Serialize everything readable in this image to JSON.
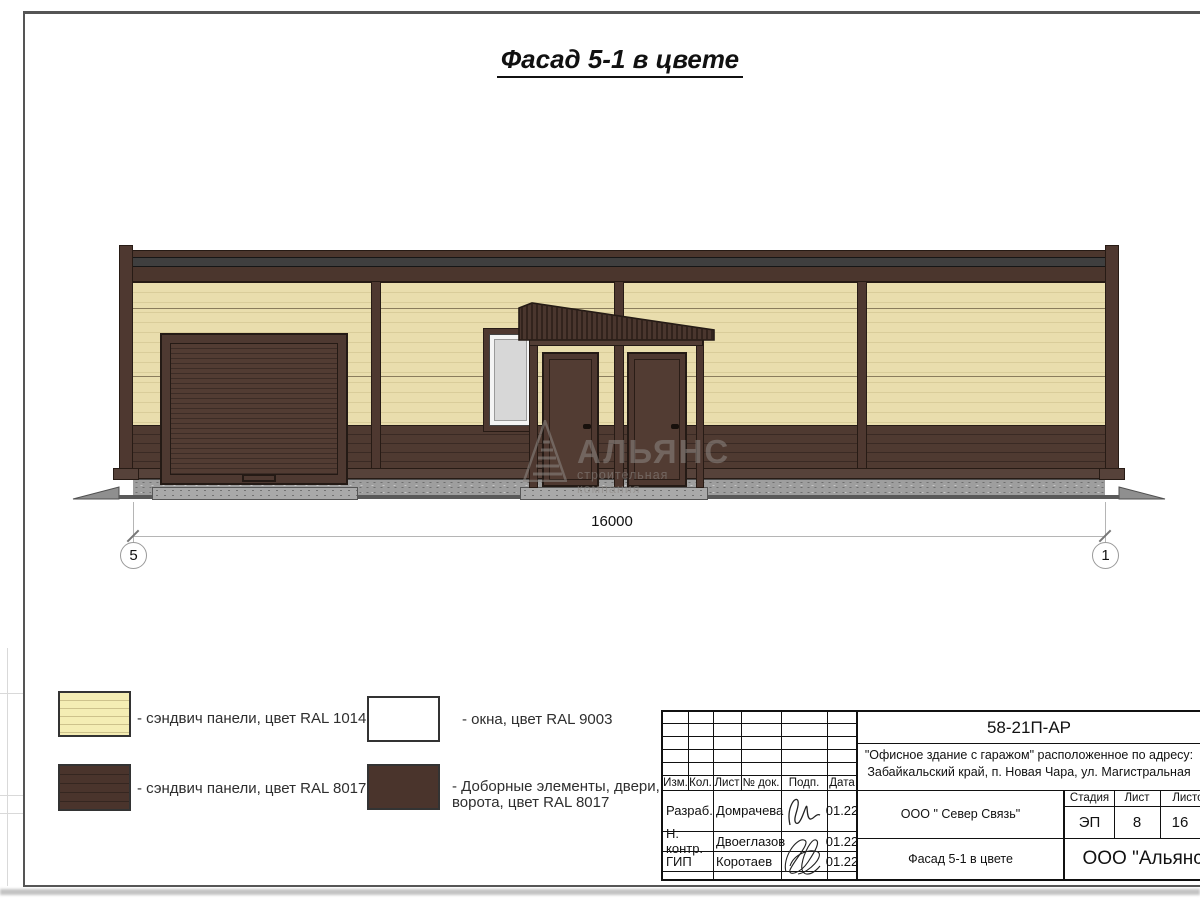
{
  "page": {
    "sheet_title": "Фасад 5-1 в цвете"
  },
  "facade": {
    "dimension_value": "16000",
    "axis_left": "5",
    "axis_right": "1",
    "watermark_title": "АЛЬЯНС",
    "watermark_subtitle": "строительная компания"
  },
  "legend": {
    "items": [
      {
        "swatch": "sandwich-panel-cream",
        "label": "- сэндвич панели, цвет RAL 1014"
      },
      {
        "swatch": "sandwich-panel-brown",
        "label": "- сэндвич панели, цвет RAL 8017"
      },
      {
        "swatch": "window-white",
        "label": "- окна, цвет RAL 9003"
      },
      {
        "swatch": "trim-doors-brown",
        "label_line1": "- Доборные элементы, двери,",
        "label_line2": "ворота, цвет RAL 8017"
      }
    ]
  },
  "title_block": {
    "doc_number": "58-21П-АР",
    "description_line1": "\"Офисное здание с гаражом\" расположенное по адресу:",
    "description_line2": "Забайкальский край, п. Новая Чара, ул. Магистральная",
    "col_izm": "Изм.",
    "col_kol": "Кол.",
    "col_list": "Лист",
    "col_ndok": "№ док.",
    "col_podp": "Подп.",
    "col_data": "Дата",
    "rows": [
      {
        "role": "Разраб.",
        "name": "Домрачева",
        "date": "01.22"
      },
      {
        "role": "Н. контр.",
        "name": "Двоеглазов",
        "date": "01.22"
      },
      {
        "role": "ГИП",
        "name": "Коротаев",
        "date": "01.22"
      }
    ],
    "client": "ООО \" Север Связь\"",
    "sheet_name": "Фасад 5-1 в цвете",
    "stage_label": "Стадия",
    "list_label": "Лист",
    "listov_label": "Листов",
    "stage_value": "ЭП",
    "list_value": "8",
    "listov_value": "16",
    "company": "ООО \"Альянс\""
  },
  "colors": {
    "panel_cream_ral1014": "#e9ddad",
    "panel_brown_ral8017": "#4a362e",
    "window_white_ral9003": "#f4f4f4",
    "window_glass": "#d7d7d7",
    "fascia_stripe": "#3f3f3f",
    "plinth_gray": "#9e9e9e"
  }
}
